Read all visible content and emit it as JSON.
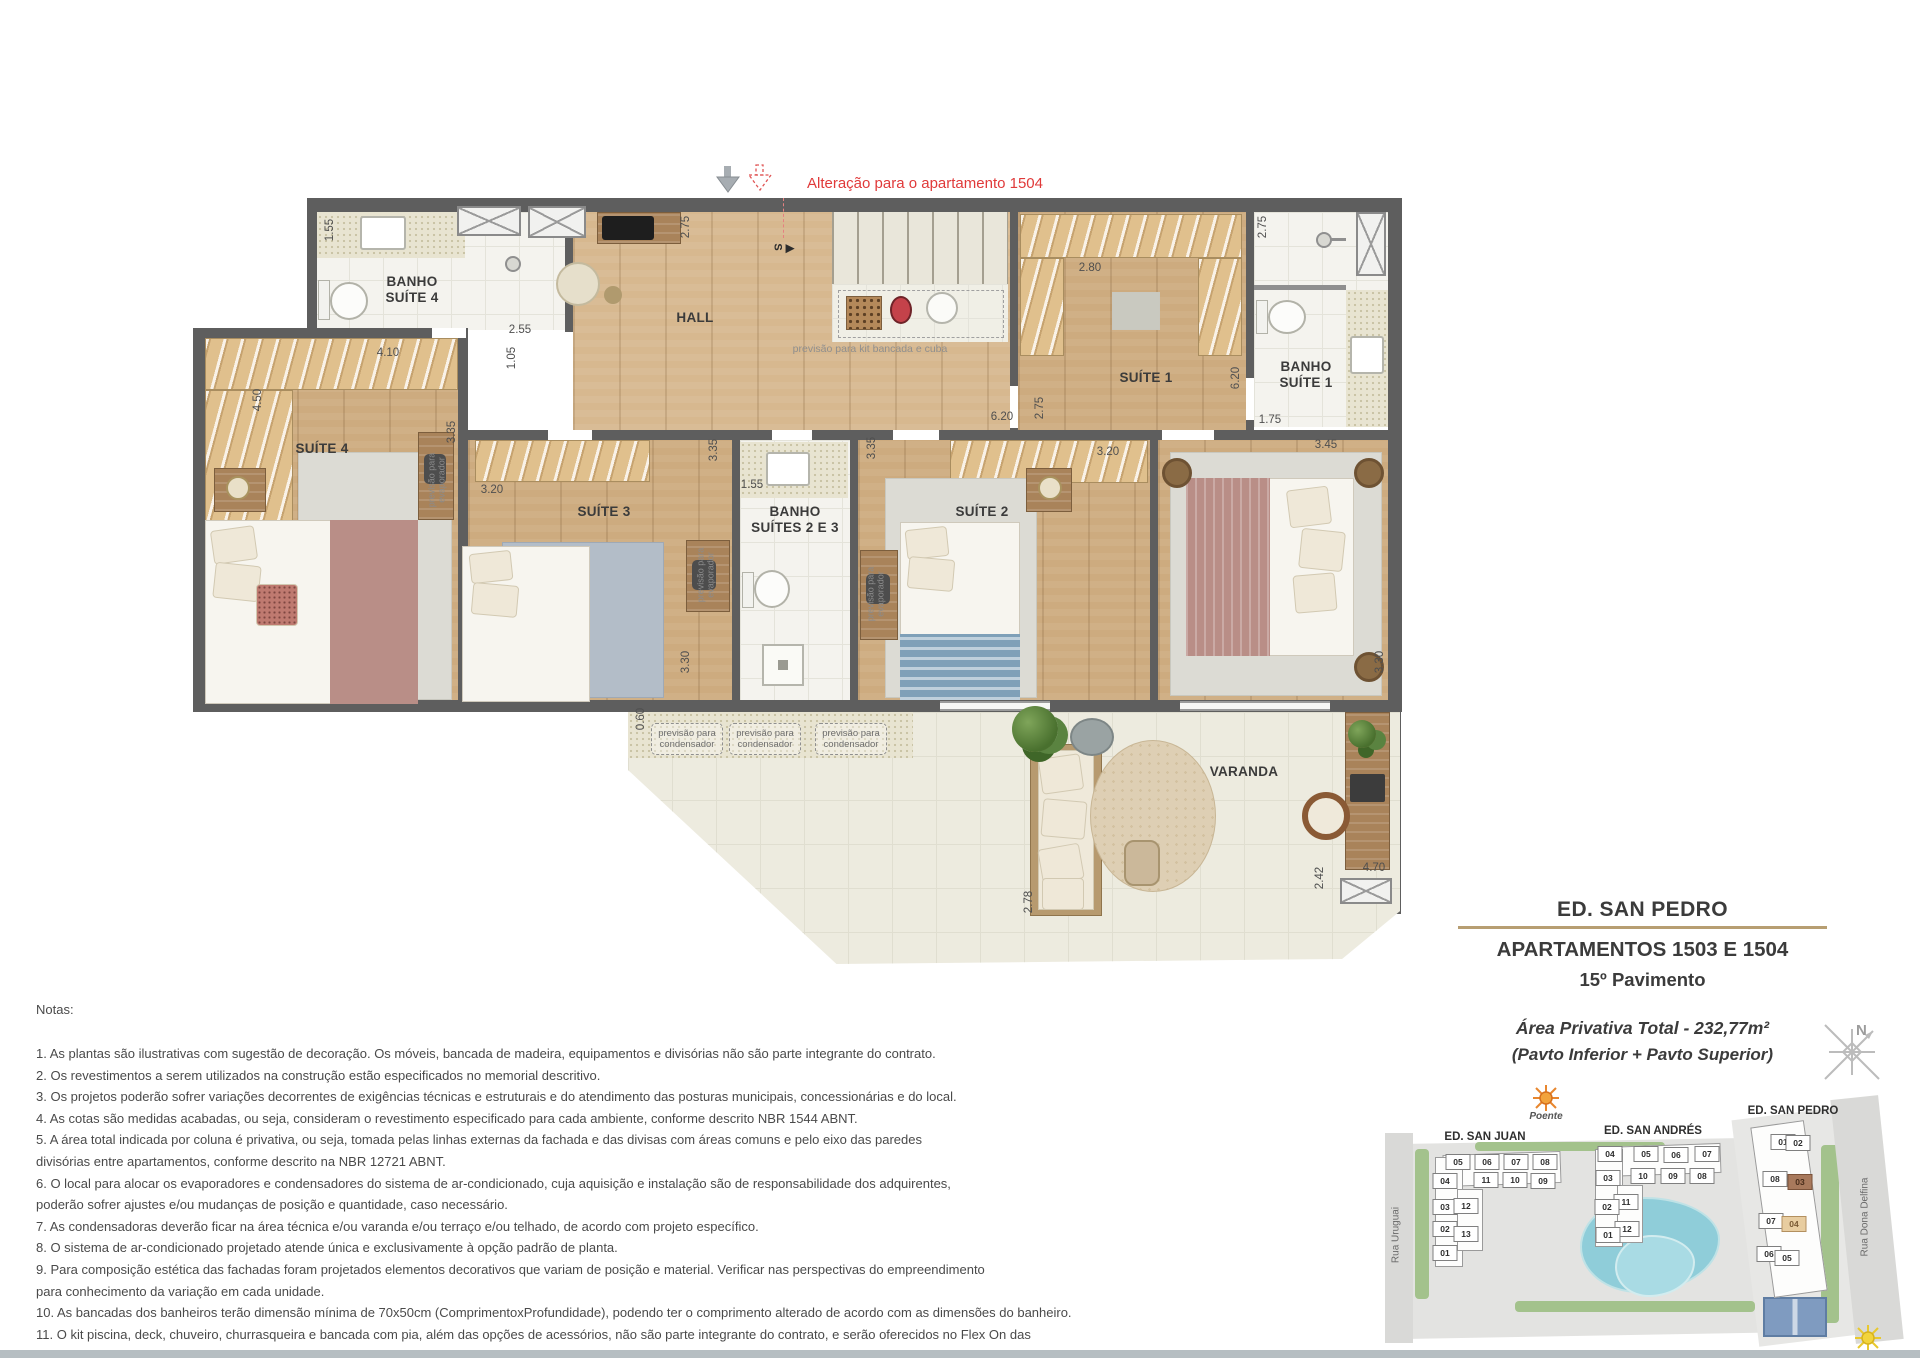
{
  "annotation": {
    "text": "Alteração para o apartamento 1504"
  },
  "floorplan": {
    "room_labels": [
      {
        "t": "BANHO\nSUÍTE 4",
        "x": 412,
        "y": 290
      },
      {
        "t": "HALL",
        "x": 695,
        "y": 318
      },
      {
        "t": "SUÍTE 4",
        "x": 322,
        "y": 449
      },
      {
        "t": "SUÍTE 3",
        "x": 604,
        "y": 512
      },
      {
        "t": "BANHO\nSUÍTES 2 E 3",
        "x": 795,
        "y": 520
      },
      {
        "t": "SUÍTE 2",
        "x": 982,
        "y": 512
      },
      {
        "t": "SUÍTE 1",
        "x": 1146,
        "y": 378
      },
      {
        "t": "BANHO\nSUÍTE 1",
        "x": 1306,
        "y": 375
      },
      {
        "t": "VARANDA",
        "x": 1244,
        "y": 772
      }
    ],
    "dimensions": [
      {
        "t": "1.55",
        "x": 330,
        "y": 230,
        "rot": -90
      },
      {
        "t": "2.55",
        "x": 520,
        "y": 330
      },
      {
        "t": "4.10",
        "x": 388,
        "y": 353
      },
      {
        "t": "1.05",
        "x": 512,
        "y": 358,
        "rot": -90
      },
      {
        "t": "4.50",
        "x": 258,
        "y": 400,
        "rot": -90
      },
      {
        "t": "2.75",
        "x": 686,
        "y": 227,
        "rot": -90
      },
      {
        "t": "3.35",
        "x": 452,
        "y": 432,
        "rot": -90
      },
      {
        "t": "3.20",
        "x": 492,
        "y": 490
      },
      {
        "t": "3.35",
        "x": 714,
        "y": 450,
        "rot": -90
      },
      {
        "t": "1.55",
        "x": 752,
        "y": 485
      },
      {
        "t": "3.35",
        "x": 872,
        "y": 448,
        "rot": -90
      },
      {
        "t": "3.30",
        "x": 686,
        "y": 662,
        "rot": -90
      },
      {
        "t": "2.80",
        "x": 1090,
        "y": 268
      },
      {
        "t": "6.20",
        "x": 1002,
        "y": 417
      },
      {
        "t": "2.75",
        "x": 1040,
        "y": 408,
        "rot": -90
      },
      {
        "t": "3.20",
        "x": 1108,
        "y": 452
      },
      {
        "t": "6.20",
        "x": 1236,
        "y": 378,
        "rot": -90
      },
      {
        "t": "2.75",
        "x": 1263,
        "y": 227,
        "rot": -90
      },
      {
        "t": "1.75",
        "x": 1270,
        "y": 420
      },
      {
        "t": "3.45",
        "x": 1326,
        "y": 445
      },
      {
        "t": "3.30",
        "x": 1380,
        "y": 662,
        "rot": -90
      },
      {
        "t": "0.60",
        "x": 641,
        "y": 719,
        "rot": -90
      },
      {
        "t": "2.42",
        "x": 1320,
        "y": 878,
        "rot": -90
      },
      {
        "t": "4.70",
        "x": 1374,
        "y": 868
      },
      {
        "t": "2.78",
        "x": 1029,
        "y": 902,
        "rot": -90
      }
    ],
    "small_texts": [
      {
        "t": "previsão para kit bancada e cuba",
        "x": 870,
        "y": 349,
        "cls": "kit"
      },
      {
        "t": "previsão para\nevaporador",
        "x": 437,
        "y": 480,
        "rot": -90
      },
      {
        "t": "previsão para\nevaporador",
        "x": 706,
        "y": 575,
        "rot": -90
      },
      {
        "t": "previsão para\nevaporador",
        "x": 876,
        "y": 594,
        "rot": -90
      },
      {
        "t": "S",
        "x": 777,
        "y": 247,
        "rot": 90,
        "cls": "stair-s"
      },
      {
        "t": "▶",
        "x": 790,
        "y": 249,
        "cls": "stair-s"
      }
    ],
    "condenser_label": "previsão para\ncondensador"
  },
  "title_block": {
    "building": "ED. SAN PEDRO",
    "apartments": "APARTAMENTOS 1503 E 1504",
    "floor": "15º Pavimento",
    "area": "Área Privativa Total - 232,77m²",
    "pavements": "(Pavto Inferior + Pavto Superior)"
  },
  "notes": {
    "heading": "Notas:",
    "lines": [
      {
        "t": "1. As plantas são ilustrativas com sugestão de decoração. Os móveis, bancada de madeira, equipamentos e divisórias não são parte integrante do contrato."
      },
      {
        "t": "2. Os revestimentos a serem utilizados na construção estão especificados no memorial descritivo."
      },
      {
        "t": "3. Os projetos poderão sofrer variações decorrentes de exigências técnicas e estruturais e do atendimento das posturas municipais, concessionárias e do local."
      },
      {
        "t": "4. As cotas são medidas acabadas, ou seja, consideram o revestimento especificado para cada ambiente, conforme descrito NBR 1544 ABNT."
      },
      {
        "t": "5. A área total indicada por coluna é privativa, ou seja, tomada pelas linhas externas da fachada e das divisas com áreas comuns e pelo eixo das paredes"
      },
      {
        "t": "divisórias entre apartamentos, conforme descrito na NBR 12721 ABNT."
      },
      {
        "t": "6. O local para alocar os evaporadores e condensadores do sistema de ar-condicionado, cuja aquisição e instalação são de responsabilidade dos adquirentes,"
      },
      {
        "t": "poderão sofrer ajustes e/ou mudanças de posição e quantidade, caso necessário."
      },
      {
        "t": "7. As condensadoras deverão ficar na área técnica e/ou varanda e/ou terraço e/ou telhado, de acordo com projeto específico."
      },
      {
        "t": "8. O sistema de ar-condicionado projetado atende única e exclusivamente à opção padrão de planta."
      },
      {
        "t": "9. Para composição estética das fachadas foram projetados elementos decorativos que variam de posição e material. Verificar nas perspectivas do empreendimento"
      },
      {
        "t": "para conhecimento da variação em cada unidade."
      },
      {
        "t": "10. As bancadas dos banheiros terão dimensão mínima de 70x50cm (ComprimentoxProfundidade), podendo ter o comprimento alterado de acordo com as dimensões do banheiro."
      },
      {
        "t": "11. O kit piscina, deck, chuveiro, churrasqueira e bancada com pia, além das opções de acessórios, não são parte integrante do contrato, e serão oferecidos no Flex On das"
      },
      {
        "t": "incorporações, mediante contratação, com custo adicional dentro do prazo oferecido pela incorporadora."
      },
      {
        "t": "A presente planta ilustra referencialmente o apartamento 1503 do Ed. San Pedro, sendo o apartamento 1504 do Ed. San Pedro espelhado.",
        "cls": "bold"
      }
    ]
  },
  "compass": {
    "label": "N"
  },
  "site_plan": {
    "poente": "Poente",
    "nascente": "Nascente",
    "street_left": "Rua Uruguai",
    "street_right": "Rua Dona Delfina",
    "buildings": [
      {
        "name": "ED. SAN JUAN",
        "units": [
          {
            "t": "05",
            "x": 73,
            "y": 77
          },
          {
            "t": "06",
            "x": 102,
            "y": 77
          },
          {
            "t": "07",
            "x": 131,
            "y": 77
          },
          {
            "t": "08",
            "x": 160,
            "y": 77
          },
          {
            "t": "04",
            "x": 60,
            "y": 96
          },
          {
            "t": "11",
            "x": 101,
            "y": 95
          },
          {
            "t": "10",
            "x": 130,
            "y": 95
          },
          {
            "t": "09",
            "x": 158,
            "y": 96
          },
          {
            "t": "03",
            "x": 60,
            "y": 122
          },
          {
            "t": "12",
            "x": 81,
            "y": 121
          },
          {
            "t": "02",
            "x": 60,
            "y": 144
          },
          {
            "t": "13",
            "x": 81,
            "y": 149
          },
          {
            "t": "01",
            "x": 60,
            "y": 168
          }
        ]
      },
      {
        "name": "ED. SAN ANDRÉS",
        "units": [
          {
            "t": "04",
            "x": 225,
            "y": 69
          },
          {
            "t": "05",
            "x": 261,
            "y": 69
          },
          {
            "t": "06",
            "x": 291,
            "y": 70
          },
          {
            "t": "07",
            "x": 322,
            "y": 69
          },
          {
            "t": "10",
            "x": 258,
            "y": 91
          },
          {
            "t": "09",
            "x": 288,
            "y": 91
          },
          {
            "t": "08",
            "x": 317,
            "y": 91
          },
          {
            "t": "03",
            "x": 223,
            "y": 93
          },
          {
            "t": "11",
            "x": 241,
            "y": 117
          },
          {
            "t": "02",
            "x": 222,
            "y": 122
          },
          {
            "t": "12",
            "x": 242,
            "y": 144
          },
          {
            "t": "01",
            "x": 223,
            "y": 150
          }
        ]
      },
      {
        "name": "ED. SAN PEDRO",
        "units": [
          {
            "t": "01",
            "x": 398,
            "y": 57
          },
          {
            "t": "02",
            "x": 413,
            "y": 58
          },
          {
            "t": "08",
            "x": 390,
            "y": 94
          },
          {
            "t": "03",
            "x": 415,
            "y": 97,
            "cls": "hl-dark"
          },
          {
            "t": "07",
            "x": 386,
            "y": 136
          },
          {
            "t": "04",
            "x": 409,
            "y": 139,
            "cls": "hl-light"
          },
          {
            "t": "06",
            "x": 384,
            "y": 169
          },
          {
            "t": "05",
            "x": 402,
            "y": 173
          }
        ]
      }
    ]
  }
}
